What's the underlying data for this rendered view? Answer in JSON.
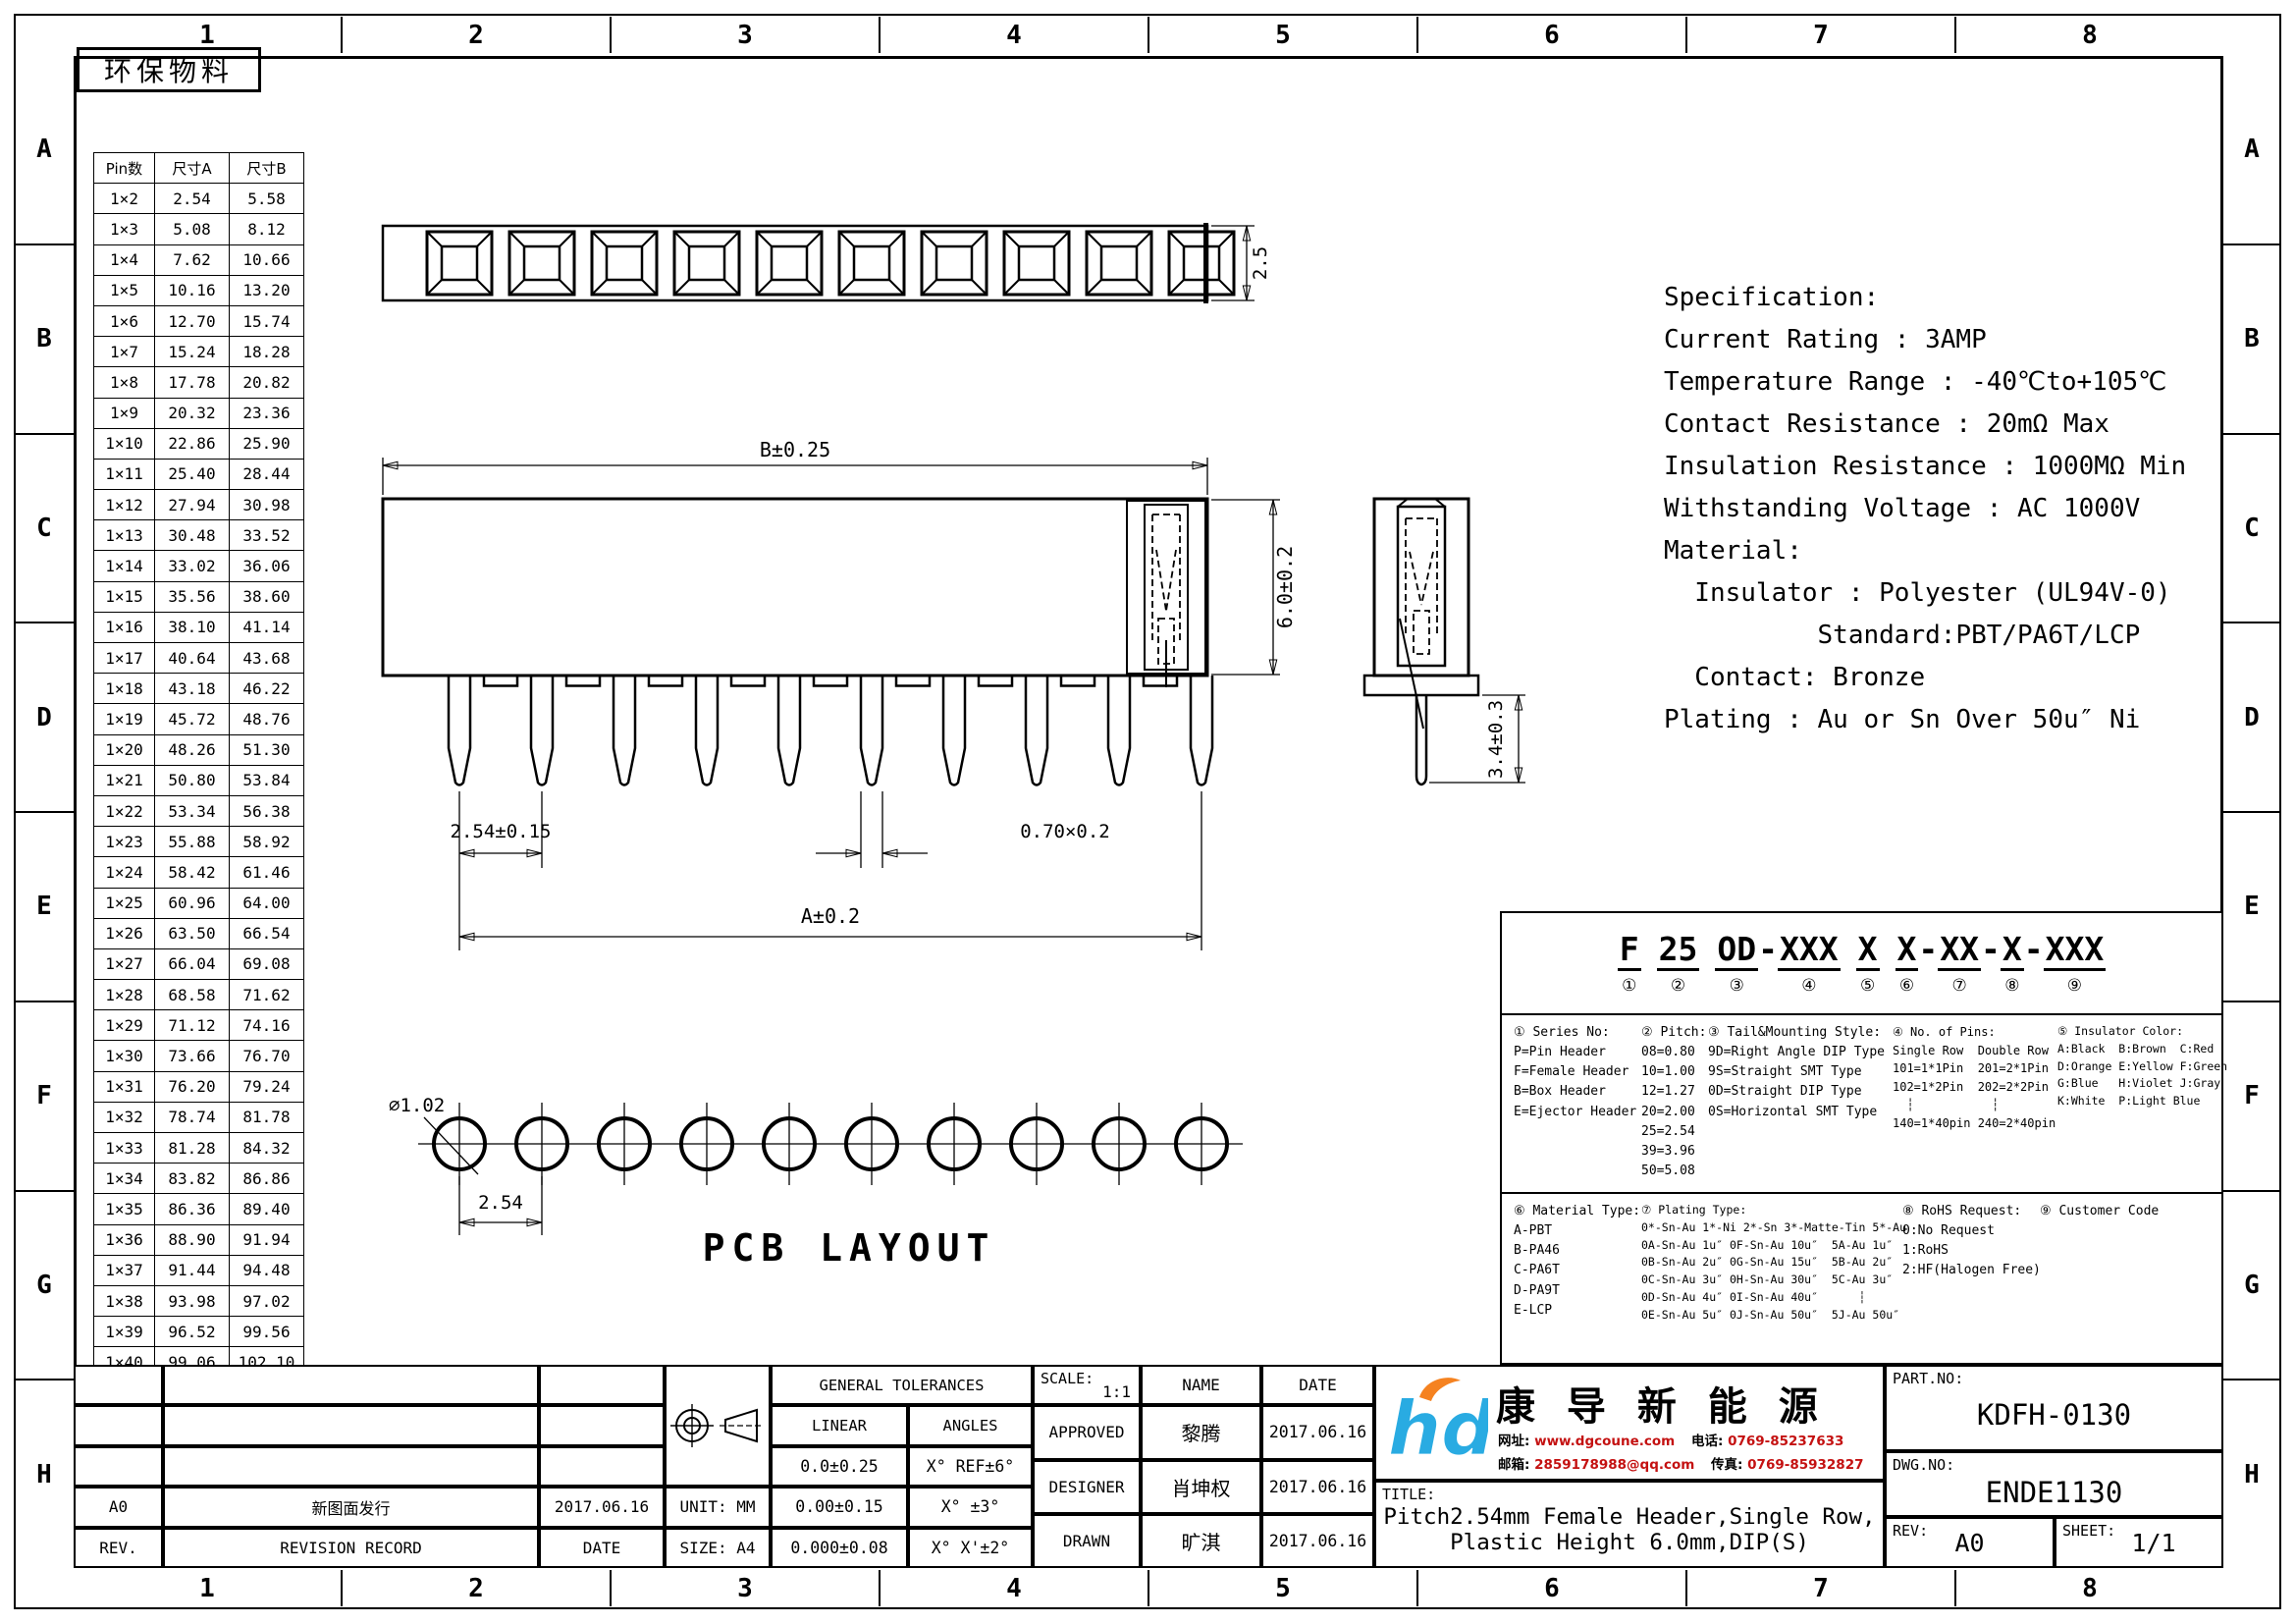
{
  "page": {
    "grid_columns": [
      "1",
      "2",
      "3",
      "4",
      "5",
      "6",
      "7",
      "8"
    ],
    "grid_rows": [
      "A",
      "B",
      "C",
      "D",
      "E",
      "F",
      "G",
      "H"
    ],
    "eco_stamp": "环保物料"
  },
  "pin_table": {
    "headers": [
      "Pin数",
      "尺寸A",
      "尺寸B"
    ],
    "rows": [
      [
        "1×2",
        "2.54",
        "5.58"
      ],
      [
        "1×3",
        "5.08",
        "8.12"
      ],
      [
        "1×4",
        "7.62",
        "10.66"
      ],
      [
        "1×5",
        "10.16",
        "13.20"
      ],
      [
        "1×6",
        "12.70",
        "15.74"
      ],
      [
        "1×7",
        "15.24",
        "18.28"
      ],
      [
        "1×8",
        "17.78",
        "20.82"
      ],
      [
        "1×9",
        "20.32",
        "23.36"
      ],
      [
        "1×10",
        "22.86",
        "25.90"
      ],
      [
        "1×11",
        "25.40",
        "28.44"
      ],
      [
        "1×12",
        "27.94",
        "30.98"
      ],
      [
        "1×13",
        "30.48",
        "33.52"
      ],
      [
        "1×14",
        "33.02",
        "36.06"
      ],
      [
        "1×15",
        "35.56",
        "38.60"
      ],
      [
        "1×16",
        "38.10",
        "41.14"
      ],
      [
        "1×17",
        "40.64",
        "43.68"
      ],
      [
        "1×18",
        "43.18",
        "46.22"
      ],
      [
        "1×19",
        "45.72",
        "48.76"
      ],
      [
        "1×20",
        "48.26",
        "51.30"
      ],
      [
        "1×21",
        "50.80",
        "53.84"
      ],
      [
        "1×22",
        "53.34",
        "56.38"
      ],
      [
        "1×23",
        "55.88",
        "58.92"
      ],
      [
        "1×24",
        "58.42",
        "61.46"
      ],
      [
        "1×25",
        "60.96",
        "64.00"
      ],
      [
        "1×26",
        "63.50",
        "66.54"
      ],
      [
        "1×27",
        "66.04",
        "69.08"
      ],
      [
        "1×28",
        "68.58",
        "71.62"
      ],
      [
        "1×29",
        "71.12",
        "74.16"
      ],
      [
        "1×30",
        "73.66",
        "76.70"
      ],
      [
        "1×31",
        "76.20",
        "79.24"
      ],
      [
        "1×32",
        "78.74",
        "81.78"
      ],
      [
        "1×33",
        "81.28",
        "84.32"
      ],
      [
        "1×34",
        "83.82",
        "86.86"
      ],
      [
        "1×35",
        "86.36",
        "89.40"
      ],
      [
        "1×36",
        "88.90",
        "91.94"
      ],
      [
        "1×37",
        "91.44",
        "94.48"
      ],
      [
        "1×38",
        "93.98",
        "97.02"
      ],
      [
        "1×39",
        "96.52",
        "99.56"
      ],
      [
        "1×40",
        "99.06",
        "102.10"
      ]
    ]
  },
  "views": {
    "top_view": {
      "cavity_count": 10,
      "height_dim": "2.5"
    },
    "front_view": {
      "pin_count": 10,
      "dim_b": "B±0.25",
      "dim_height": "6.0±0.2",
      "dim_pitch": "2.54±0.15",
      "dim_pin": "0.70×0.2",
      "dim_a": "A±0.2"
    },
    "side_view": {
      "dim_tail": "3.4±0.3"
    },
    "pcb_layout": {
      "hole_count": 10,
      "dim_dia": "∅1.02",
      "dim_pitch": "2.54",
      "label": "PCB LAYOUT"
    }
  },
  "specification": {
    "lines": [
      "Specification:",
      "Current Rating : 3AMP",
      "Temperature Range : -40℃to+105℃",
      "Contact Resistance : 20mΩ Max",
      "Insulation Resistance : 1000MΩ Min",
      "Withstanding Voltage : AC 1000V",
      "Material:",
      "  Insulator : Polyester (UL94V-0)",
      "          Standard:PBT/PA6T/LCP",
      "  Contact: Bronze",
      "Plating : Au or Sn Over 50u″ Ni"
    ]
  },
  "part_code": {
    "tokens": [
      {
        "t": "F",
        "n": "①",
        "gap": true
      },
      {
        "t": "25",
        "n": "②",
        "gap": true
      },
      {
        "t": "OD",
        "n": "③"
      },
      {
        "t": "-"
      },
      {
        "t": "XXX",
        "n": "④",
        "gap": true
      },
      {
        "t": "X",
        "n": "⑤",
        "gap": true
      },
      {
        "t": "X",
        "n": "⑥"
      },
      {
        "t": "-"
      },
      {
        "t": "XX",
        "n": "⑦"
      },
      {
        "t": "-"
      },
      {
        "t": "X",
        "n": "⑧"
      },
      {
        "t": "-"
      },
      {
        "t": "XXX",
        "n": "⑨"
      }
    ],
    "series": {
      "title": "① Series No:",
      "lines": [
        "P=Pin Header",
        "F=Female Header",
        "B=Box Header",
        "E=Ejector Header"
      ]
    },
    "pitch": {
      "title": "② Pitch:",
      "lines": [
        "08=0.80",
        "10=1.00",
        "12=1.27",
        "20=2.00",
        "25=2.54",
        "39=3.96",
        "50=5.08"
      ]
    },
    "tail": {
      "title": "③ Tail&Mounting Style:",
      "lines": [
        "9D=Right Angle DIP Type",
        "9S=Straight SMT Type",
        "0D=Straight DIP Type",
        "0S=Horizontal SMT Type"
      ]
    },
    "pins": {
      "title": "④ No. of Pins:",
      "lines": [
        "Single Row  Double Row",
        "101=1*1Pin  201=2*1Pin",
        "102=1*2Pin  202=2*2Pin",
        "  ┆           ┆",
        "140=1*40pin 240=2*40pin"
      ]
    },
    "color": {
      "title": "⑤ Insulator Color:",
      "lines": [
        "A:Black  B:Brown  C:Red",
        "D:Orange E:Yellow F:Green",
        "G:Blue   H:Violet J:Gray",
        "K:White  P:Light Blue"
      ]
    },
    "material": {
      "title": "⑥ Material Type:",
      "lines": [
        "A-PBT",
        "B-PA46",
        "C-PA6T",
        "D-PA9T",
        "E-LCP"
      ]
    },
    "plating": {
      "title": "⑦ Plating Type:",
      "lines": [
        "0*-Sn-Au 1*-Ni 2*-Sn 3*-Matte-Tin 5*-Au",
        "0A-Sn-Au 1u″ 0F-Sn-Au 10u″  5A-Au 1u″",
        "0B-Sn-Au 2u″ 0G-Sn-Au 15u″  5B-Au 2u″",
        "0C-Sn-Au 3u″ 0H-Sn-Au 30u″  5C-Au 3u″",
        "0D-Sn-Au 4u″ 0I-Sn-Au 40u″      ┆",
        "0E-Sn-Au 5u″ 0J-Sn-Au 50u″  5J-Au 50u″"
      ]
    },
    "rohs": {
      "title": "⑧ RoHS Request:",
      "lines": [
        "0:No Request",
        "1:RoHS",
        "2:HF(Halogen Free)"
      ]
    },
    "customer": {
      "title": "⑨ Customer Code",
      "lines": []
    }
  },
  "title_block": {
    "revision": {
      "rows": [
        [
          "",
          "",
          ""
        ],
        [
          "",
          "",
          ""
        ],
        [
          "",
          "",
          ""
        ],
        [
          "A0",
          "新图面发行",
          "2017.06.16"
        ],
        [
          "REV.",
          "REVISION RECORD",
          "DATE"
        ]
      ]
    },
    "tolerances": {
      "title": "GENERAL TOLERANCES",
      "linear": "LINEAR",
      "angles": "ANGLES",
      "rows": [
        [
          "0.0±0.25",
          "X° REF±6°"
        ],
        [
          "0.00±0.15",
          "X° ±3°"
        ],
        [
          "0.000±0.08",
          "X° X'±2°"
        ]
      ],
      "unit": "UNIT: MM",
      "size": "SIZE: A4"
    },
    "approvals": {
      "scale_label": "SCALE:",
      "scale": "1:1",
      "name_header": "NAME",
      "date_header": "DATE",
      "rows": [
        [
          "APPROVED",
          "黎腾",
          "2017.06.16"
        ],
        [
          "DESIGNER",
          "肖坤权",
          "2017.06.16"
        ],
        [
          "DRAWN",
          "旷淇",
          "2017.06.16"
        ]
      ]
    },
    "company": {
      "logo_text": "hd",
      "name": "康 导 新 能 源",
      "website_label": "网址:",
      "website": "www.dgcoune.com",
      "phone_label": "电话:",
      "phone": "0769-85237633",
      "email_label": "邮箱:",
      "email": "2859178988@qq.com",
      "fax_label": "传真:",
      "fax": "0769-85932827"
    },
    "title_label": "TITLE:",
    "title_line1": "Pitch2.54mm Female Header,Single Row,",
    "title_line2": "Plastic Height 6.0mm,DIP(S)",
    "part_no_label": "PART.NO:",
    "part_no": "KDFH-0130",
    "dwg_no_label": "DWG.NO:",
    "dwg_no": "ENDE1130",
    "rev_label": "REV:",
    "rev": "A0",
    "sheet_label": "SHEET:",
    "sheet": "1/1"
  },
  "colors": {
    "logo_blue": "#29abe2",
    "logo_orange": "#f58220",
    "contact_red": "#c41111",
    "line_black": "#000000"
  }
}
